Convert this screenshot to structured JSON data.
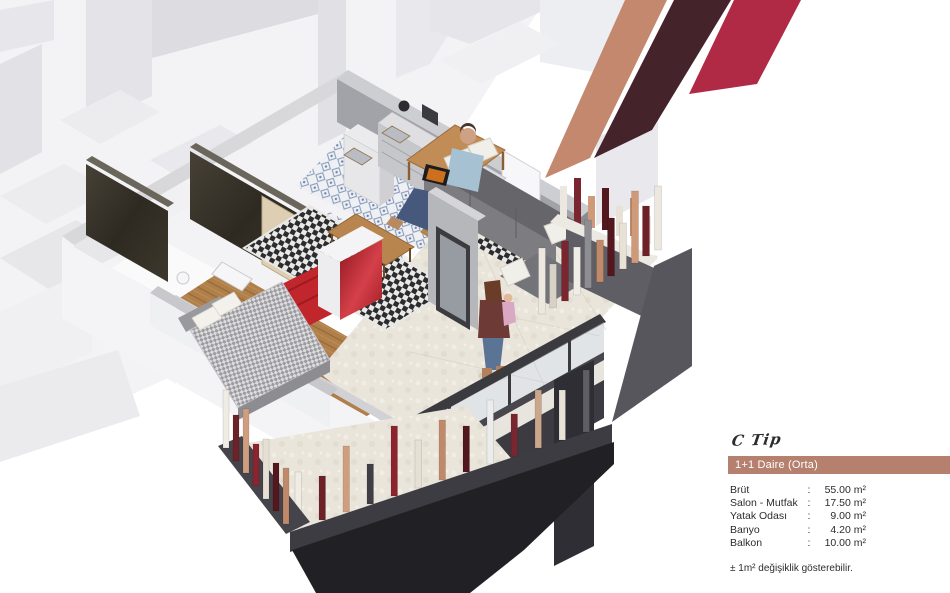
{
  "info_panel": {
    "type_label": "C Tip",
    "unit_title": "1+1 Daire (Orta)",
    "colon": ":",
    "bar_color": "#b5806d",
    "rows": [
      {
        "label": "Brüt",
        "value": "55.00 m²"
      },
      {
        "label": "Salon - Mutfak",
        "value": "17.50 m²"
      },
      {
        "label": "Yatak Odası",
        "value": "9.00 m²"
      },
      {
        "label": "Banyo",
        "value": "4.20 m²"
      },
      {
        "label": "Balkon",
        "value": "10.00 m²"
      }
    ],
    "note": "± 1m²  değişiklik gösterebilir."
  },
  "brand_stripes": {
    "tan": "#c4886e",
    "maroon": "#45232a",
    "red": "#b12a45"
  }
}
